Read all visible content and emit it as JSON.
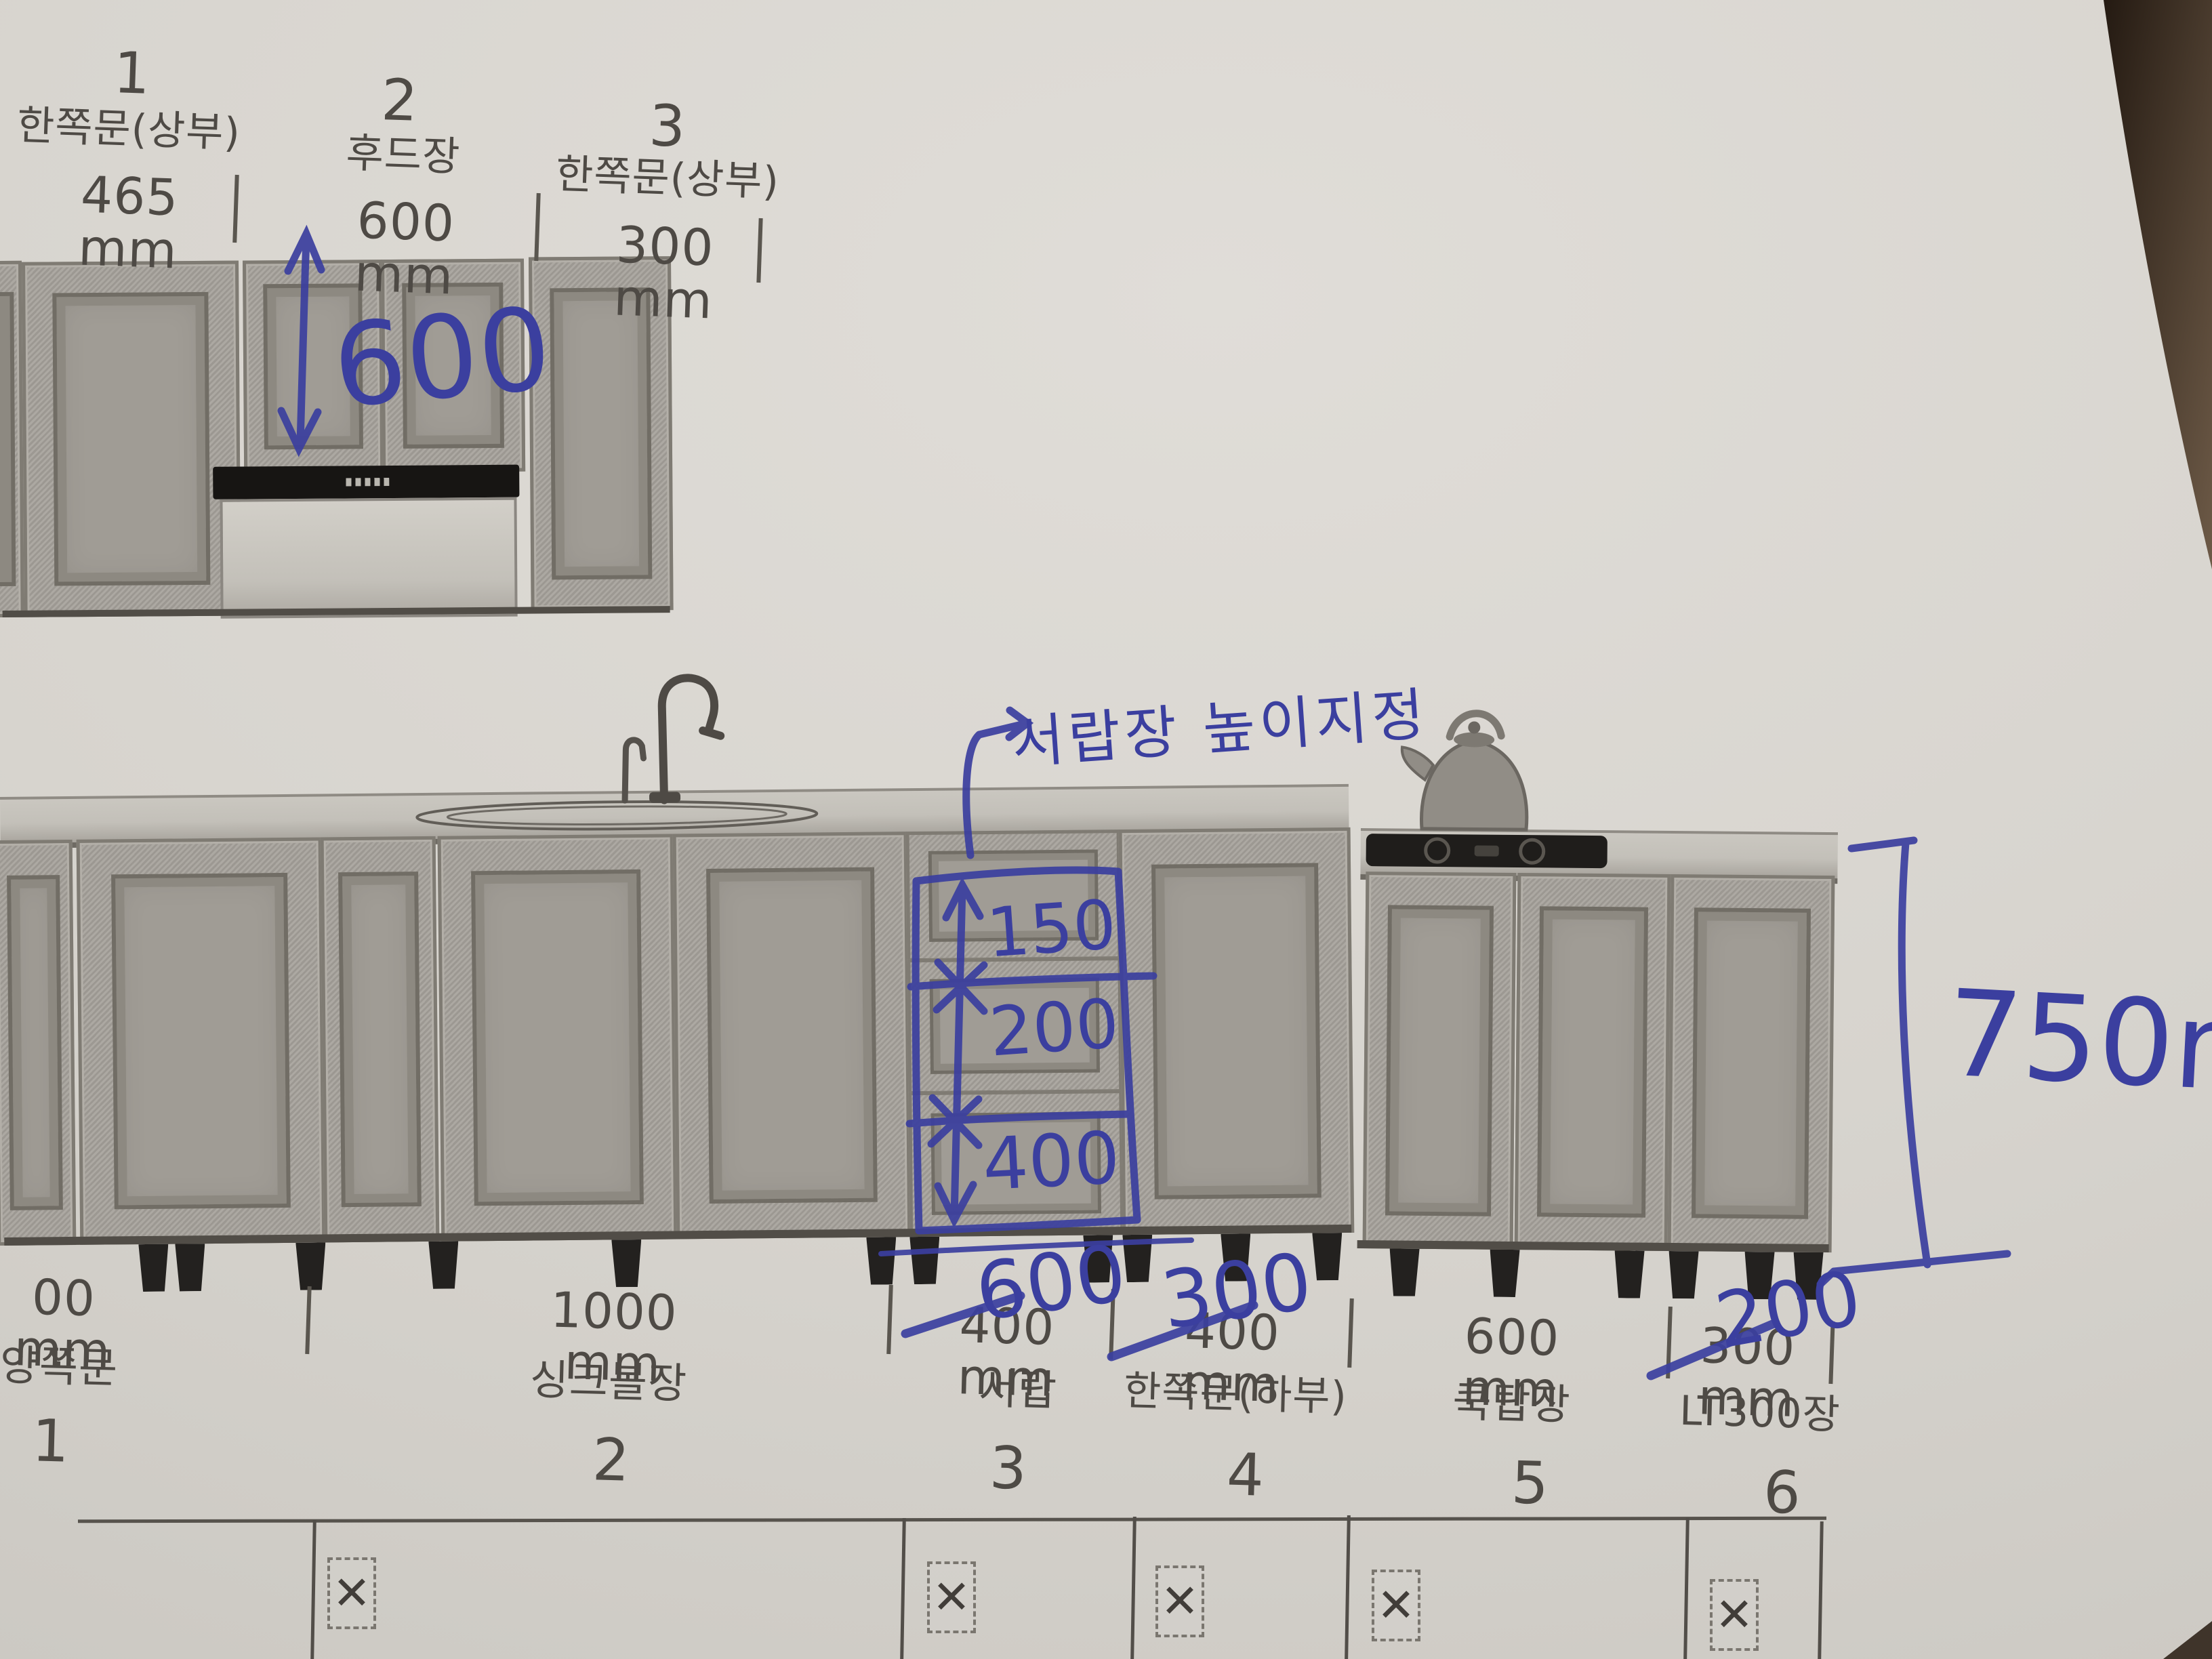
{
  "pen_color": "#3b3f9f",
  "upper": {
    "cabinets": [
      {
        "no": "1",
        "type": "한쪽문(상부)",
        "width": "465 mm"
      },
      {
        "no": "2",
        "type": "후드장",
        "width": "600 mm"
      },
      {
        "no": "3",
        "type": "한쪽문(상부)",
        "width": "300 mm"
      }
    ],
    "pen_height_note": "600"
  },
  "base": {
    "cabinets": [
      {
        "no": "1",
        "type": "양쪽문",
        "width": "00 mm"
      },
      {
        "no": "2",
        "type": "싱크볼장",
        "width": "1000 mm"
      },
      {
        "no": "3",
        "type": "서랍",
        "width": "400 mm",
        "pen_width": "600"
      },
      {
        "no": "4",
        "type": "한쪽문(하부)",
        "width": "400 mm",
        "pen_width": "300"
      },
      {
        "no": "5",
        "type": "쿡탑장",
        "width": "600 mm"
      },
      {
        "no": "6",
        "type": "LT300장",
        "width": "300 mm",
        "pen_width": "200"
      }
    ],
    "pen_drawer_heights": {
      "top": "150",
      "middle": "200",
      "bottom": "400"
    },
    "pen_note": "서랍장 높이지정",
    "pen_total_height": "750mm"
  },
  "table": {
    "mark": "✕"
  }
}
